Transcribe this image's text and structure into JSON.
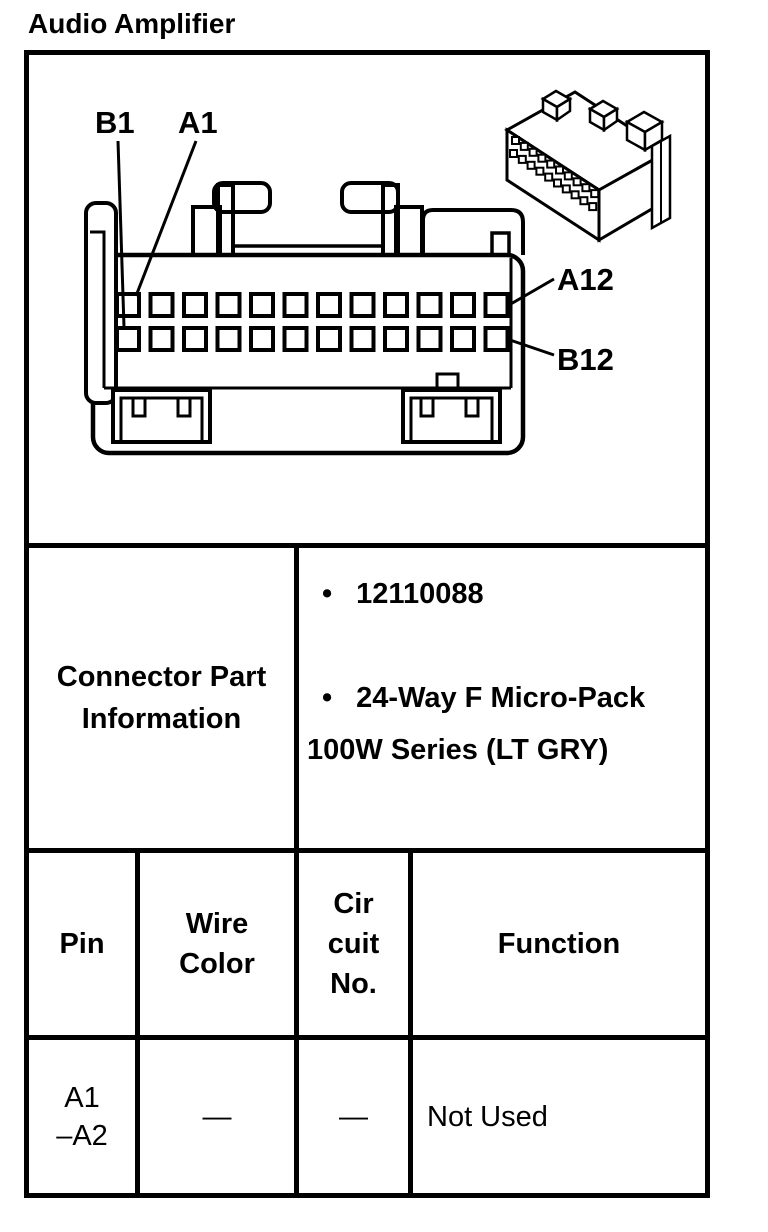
{
  "page_title": "Audio Amplifier",
  "diagram": {
    "pins_per_row": 12,
    "pin_labels": {
      "b1": "B1",
      "a1": "A1",
      "a12": "A12",
      "b12": "B12"
    }
  },
  "connector_info": {
    "title_lines": [
      "Connector Part",
      "Information"
    ],
    "bullet_char": "•",
    "bullets": [
      {
        "lines": [
          "12110088"
        ]
      },
      {
        "lines": [
          "24-Way F Micro-Pack",
          "100W Series (LT GRY)"
        ]
      }
    ]
  },
  "pin_table": {
    "headers": [
      {
        "lines": [
          "Pin"
        ]
      },
      {
        "lines": [
          "Wire",
          "Color"
        ]
      },
      {
        "lines": [
          "Cir",
          "cuit",
          "No."
        ]
      },
      {
        "lines": [
          "Function"
        ]
      }
    ],
    "rows": [
      {
        "pin_lines": [
          "A1",
          "–A2"
        ],
        "wire_color": "—",
        "circuit_no": "—",
        "function": "Not Used"
      }
    ]
  },
  "colors": {
    "ink": "#000000",
    "paper": "#ffffff"
  }
}
